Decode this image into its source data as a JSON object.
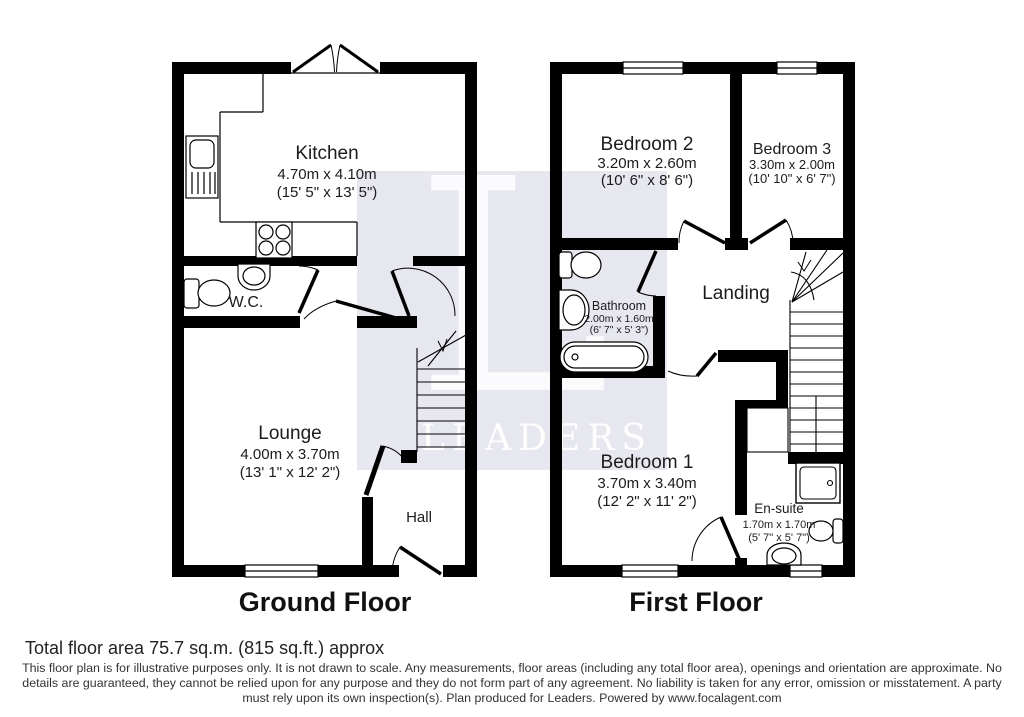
{
  "watermark": {
    "letter": "L",
    "word": "LEADERS",
    "bg_color": "#e7e7f0",
    "fg_color": "#fbfbfd"
  },
  "ground_floor": {
    "title": "Ground Floor",
    "kitchen": {
      "name": "Kitchen",
      "metric": "4.70m x 4.10m",
      "imperial": "(15' 5\" x 13' 5\")"
    },
    "wc": {
      "name": "W.C."
    },
    "lounge": {
      "name": "Lounge",
      "metric": "4.00m x 3.70m",
      "imperial": "(13' 1\" x 12' 2\")"
    },
    "hall": {
      "name": "Hall"
    }
  },
  "first_floor": {
    "title": "First Floor",
    "bedroom2": {
      "name": "Bedroom 2",
      "metric": "3.20m x 2.60m",
      "imperial": "(10' 6\" x 8' 6\")"
    },
    "bedroom3": {
      "name": "Bedroom 3",
      "metric": "3.30m x 2.00m",
      "imperial": "(10' 10\" x 6' 7\")"
    },
    "bathroom": {
      "name": "Bathroom",
      "metric": "2.00m x 1.60m",
      "imperial": "(6' 7\" x 5' 3\")"
    },
    "landing": {
      "name": "Landing"
    },
    "bedroom1": {
      "name": "Bedroom 1",
      "metric": "3.70m x 3.40m",
      "imperial": "(12' 2\" x 11' 2\")"
    },
    "ensuite": {
      "name": "En-suite",
      "metric": "1.70m x 1.70m",
      "imperial": "(5' 7\" x 5' 7\")"
    }
  },
  "footer": {
    "total_area": "Total floor area 75.7 sq.m. (815 sq.ft.) approx",
    "disclaimer_line1": "This floor plan is for illustrative purposes only. It is not drawn to scale. Any measurements, floor areas (including any total floor area), openings and orientation are approximate. No",
    "disclaimer_line2": "details are guaranteed, they cannot be relied upon for any purpose and they do not form part of any agreement. No liability is taken for any error, omission or misstatement. A party",
    "disclaimer_line3": "must rely upon its own inspection(s). Plan produced for Leaders. Powered by www.focalagent.com"
  }
}
